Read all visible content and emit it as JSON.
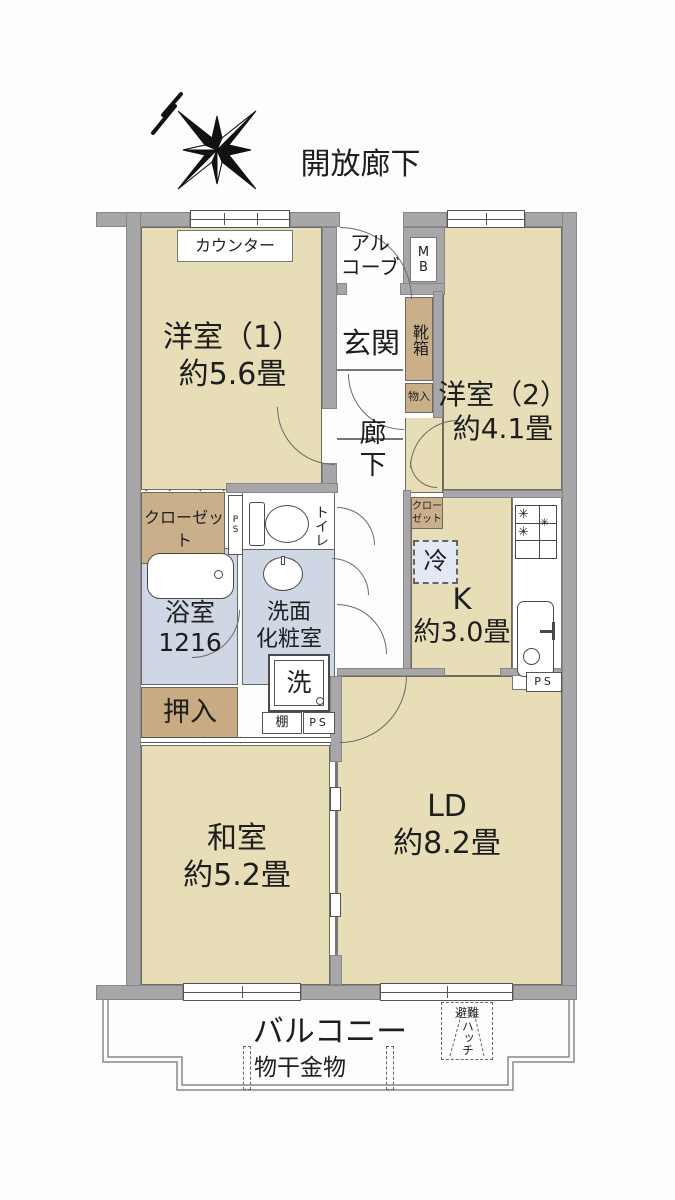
{
  "floorplan": {
    "open_corridor_label": "開放廊下",
    "rooms": {
      "western_room_1": {
        "lines": [
          "洋室（1）",
          "約5.6畳"
        ]
      },
      "western_room_2": {
        "lines": [
          "洋室（2）",
          "約4.1畳"
        ]
      },
      "japanese_room": {
        "lines": [
          "和室",
          "約5.2畳"
        ]
      },
      "living_dining": {
        "lines": [
          "LD",
          "約8.2畳"
        ]
      },
      "kitchen": {
        "lines": [
          "K",
          "約3.0畳"
        ]
      },
      "entrance": "玄関",
      "hallway": "廊下",
      "alcove": {
        "lines": [
          "アル",
          "コーブ"
        ]
      },
      "bathroom": {
        "lines": [
          "浴室",
          "1216"
        ]
      },
      "washroom": {
        "lines": [
          "洗面",
          "化粧室"
        ]
      },
      "toilet": "トイレ",
      "balcony": "バルコニー"
    },
    "fixtures": {
      "counter": "カウンター",
      "shoe_cabinet": "靴箱",
      "storage_small": "物入",
      "closet_west": "クローゼット",
      "closet_kitchen": "クローゼット",
      "oshiire_closet": "押入",
      "refrigerator": "冷",
      "washing_machine": "洗",
      "shelf": "棚",
      "meter_box": "MB",
      "pipe_space_left": "PS",
      "pipe_space_mid": "PS",
      "pipe_space_kitchen": "PS",
      "laundry_hardware": "物干金物",
      "escape_hatch": {
        "lines": [
          "避難",
          "ハッチ"
        ]
      }
    },
    "colors": {
      "room_beige": "#e7ddb6",
      "storage_tan": "#c9af8a",
      "wet_area_blue": "#cfd6e4",
      "wall_gray": "#a7a7a9",
      "fridge_blue": "#e3e9f4"
    }
  }
}
